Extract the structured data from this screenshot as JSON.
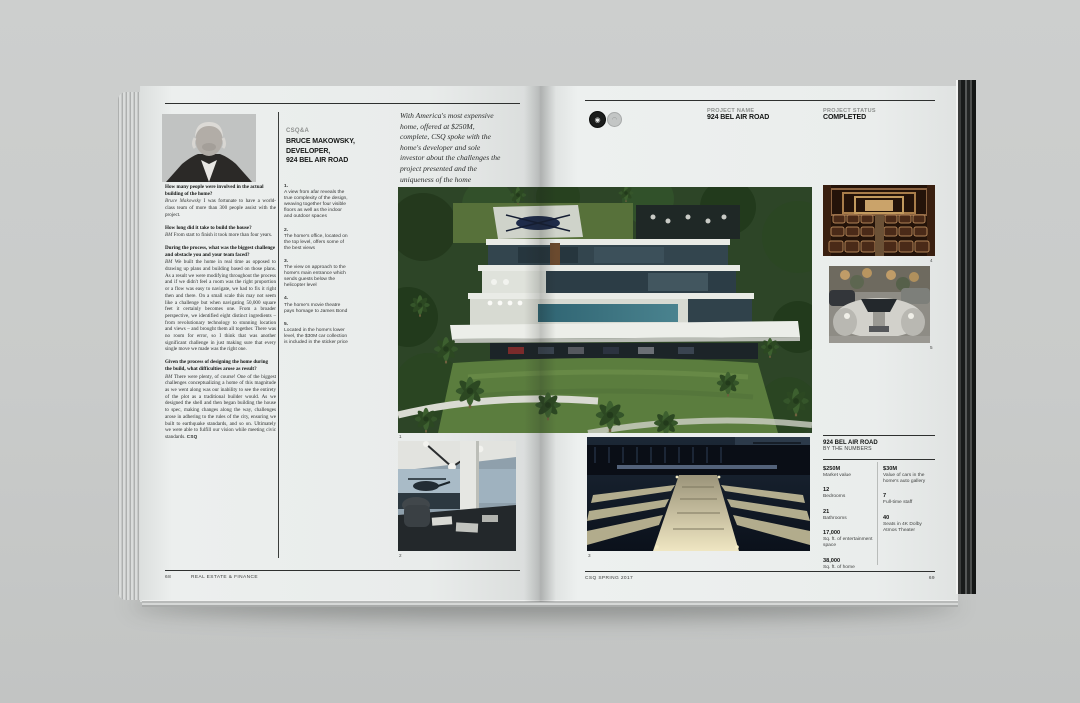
{
  "colors": {
    "background": "#c9cbca",
    "page": "#e9eceb",
    "text": "#2b2d2c",
    "muted_label": "#8d908e",
    "rule": "#2e302f"
  },
  "icons": {
    "header_badges": [
      "target-pin-badge-icon",
      "camera-badge-icon"
    ]
  },
  "left_page": {
    "masthead": {
      "kicker": "CSQ&A",
      "line1": "BRUCE MAKOWSKY,",
      "line2": "DEVELOPER,",
      "line3": "924 BEL AIR ROAD"
    },
    "intro": "With America's most expensive home, offered at $250M, complete, CSQ spoke with the home's developer and sole investor about the challenges the project presented and the uniqueness of the home",
    "qa": [
      {
        "q": "How many people were involved in the actual building of the home?",
        "prefix": "Bruce Makowsky",
        "a": "I was fortunate to have a world-class team of more than 300 people assist with the project."
      },
      {
        "q": "How long did it take to build the house?",
        "prefix": "BM",
        "a": "From start to finish it took more than four years."
      },
      {
        "q": "During the process, what was the biggest challenge and obstacle you and your team faced?",
        "prefix": "BM",
        "a": "We built the home in real time as opposed to drawing up plans and building based on those plans. As a result we were modifying throughout the process and if we didn't feel a room was the right proportion or a flow was easy to navigate, we had to fix it right then and there. On a small scale this may not seem like a challenge but when navigating 50,000 square feet it certainly becomes one. From a broader perspective, we identified eight distinct ingredients – from revolutionary technology to stunning location and views – and brought them all together. There was no room for error, so I think that was another significant challenge in just making sure that every single move we made was the right one."
      },
      {
        "q": "Given the process of designing the home during the build, what difficulties arose as result?",
        "prefix": "BM",
        "a": "There were plenty, of course! One of the biggest challenges conceptualizing a home of this magnitude as we went along was our inability to see the entirety of the plot as a traditional builder would. As we designed the shell and then began building the house to spec, making changes along the way, challenges arose in adhering to the rules of the city, ensuring we built to earthquake standards, and so on. Ultimately we were able to fulfill our vision while meeting civic standards."
      }
    ],
    "end_mark": "CSQ",
    "captions": [
      {
        "num": "1.",
        "text": "A view from afar reveals the true complexity of the design, weaving together four visible floors as well as the indoor and outdoor spaces"
      },
      {
        "num": "2.",
        "text": "The home's office, located on the top level, offers some of the best views"
      },
      {
        "num": "3.",
        "text": "The view on approach to the home's main entrance which sends guests below the helicopter level"
      },
      {
        "num": "4.",
        "text": "The home's movie theatre pays homage to James Bond"
      },
      {
        "num": "5.",
        "text": "Located in the home's lower level, the $30M car collection is included in the sticker price"
      }
    ],
    "footer": {
      "page": "68",
      "section": "REAL ESTATE & FINANCE"
    }
  },
  "right_page": {
    "header": {
      "name_label": "PROJECT NAME",
      "name_value": "924 BEL AIR ROAD",
      "status_label": "PROJECT STATUS",
      "status_value": "COMPLETED"
    },
    "by_the_numbers": {
      "title": "924 BEL AIR ROAD",
      "subtitle": "BY THE NUMBERS",
      "col1": [
        {
          "value": "$250M",
          "label": "Market value"
        },
        {
          "value": "12",
          "label": "Bedrooms"
        },
        {
          "value": "21",
          "label": "Bathrooms"
        },
        {
          "value": "17,000",
          "label": "Sq. ft. of entertainment space"
        },
        {
          "value": "38,000",
          "label": "Sq. ft. of home"
        }
      ],
      "col2": [
        {
          "value": "$30M",
          "label": "Value of cars in the home's auto gallery"
        },
        {
          "value": "7",
          "label": "Full-time staff"
        },
        {
          "value": "40",
          "label": "Seats in 4K Dolby Atmos Theater"
        }
      ]
    },
    "footer": {
      "issue": "CSQ SPRING 2017",
      "page": "69"
    }
  },
  "photo_labels": {
    "main": "1",
    "office": "2",
    "entrance": "3",
    "theatre": "4",
    "cars": "5"
  }
}
